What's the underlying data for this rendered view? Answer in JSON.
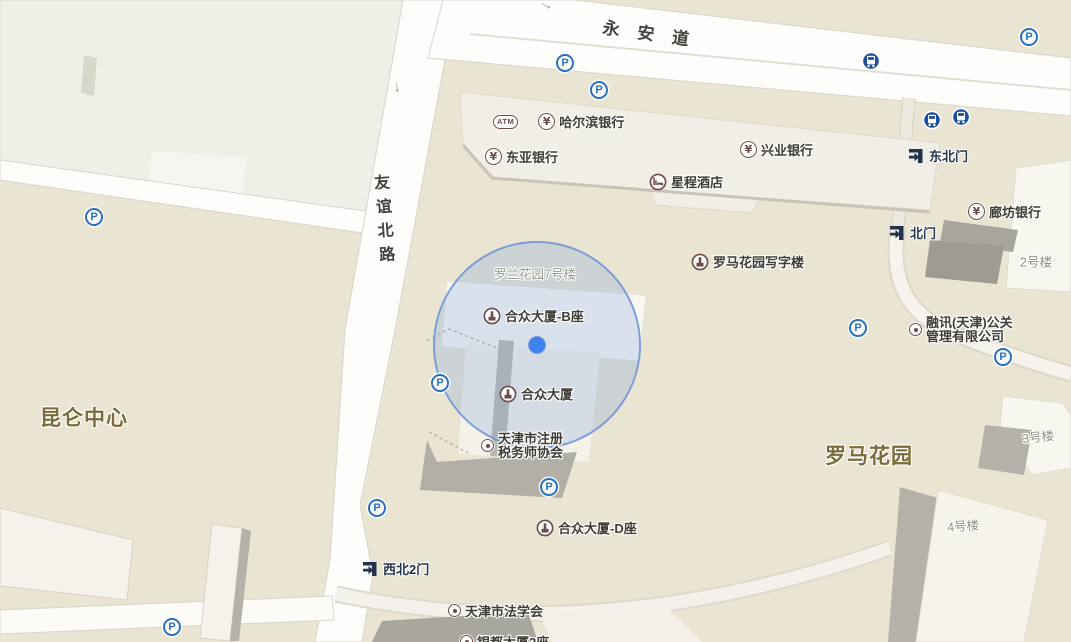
{
  "roads": {
    "yongan": "永安道",
    "youyi_north": "友谊北路"
  },
  "districts": {
    "kunlun_center": "昆仑中心",
    "roma_garden": "罗马花园"
  },
  "building_labels": {
    "luolan_7": "罗兰花园7号楼",
    "no2": "2号楼",
    "no3": "3号楼",
    "no4": "4号楼"
  },
  "gates": {
    "northeast": "东北门",
    "north": "北门",
    "northwest2": "西北2门"
  },
  "pois": {
    "harbin_bank": "哈尔滨银行",
    "dongya_bank": "东亚银行",
    "xingye_bank": "兴业银行",
    "langfang_bank": "廊坊银行",
    "xingcheng_hotel": "星程酒店",
    "roma_office": "罗马花园写字楼",
    "hezhong_b": "合众大厦-B座",
    "hezhong": "合众大厦",
    "hezhong_d": "合众大厦-D座",
    "tax_assoc_line1": "天津市注册",
    "tax_assoc_line2": "税务师协会",
    "rongxun_line1": "融讯(天津)公关",
    "rongxun_line2": "管理有限公司",
    "law_society": "天津市法学会",
    "clipped_bottom": "银都大厦2座"
  },
  "glyphs": {
    "parking": "P",
    "yuan": "¥",
    "atm": "ATM",
    "one_way_down": "↓",
    "one_way_right": "→"
  },
  "colors": {
    "background_tan": "#e9e5d2",
    "block_light": "#f0efe7",
    "building_white": "#f7f6ef",
    "building_side_gray": "#b3b1a8",
    "road_white": "#fdfdfc",
    "location_blue": "#3e82f1",
    "accuracy_stroke": "#6e94d8",
    "parking_blue": "#2a6fc0",
    "bus_blue": "#1c4f9e",
    "poi_maroon": "#6d4b4b",
    "gate_navy": "#24324f",
    "district_brown": "#7c6a39"
  }
}
